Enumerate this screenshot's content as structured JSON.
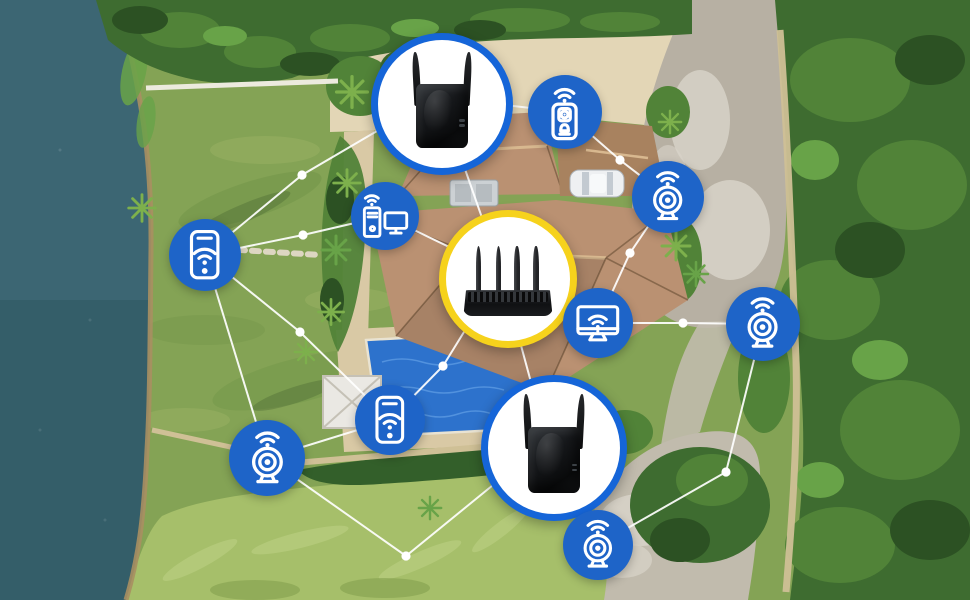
{
  "network": {
    "colors": {
      "circle_blue": "#1e64c8",
      "ring_blue": "#1565d8",
      "ring_yellow": "#f6d21c",
      "device_bg": "#ffffff",
      "line": "#ffffff",
      "icon_stroke": "#ffffff"
    },
    "nodes": [
      {
        "id": "extender-top",
        "kind": "device",
        "device": "wifi-extender",
        "ring": "blue",
        "x": 435,
        "y": 97,
        "r": 64
      },
      {
        "id": "doorbell",
        "kind": "icon",
        "icon": "video-doorbell",
        "x": 565,
        "y": 112,
        "r": 37
      },
      {
        "id": "phone-left",
        "kind": "icon",
        "icon": "smartphone",
        "x": 205,
        "y": 255,
        "r": 36
      },
      {
        "id": "desktop-pc",
        "kind": "icon",
        "icon": "desktop-pc",
        "x": 385,
        "y": 216,
        "r": 34
      },
      {
        "id": "router",
        "kind": "device",
        "device": "wifi-router",
        "ring": "yellow",
        "x": 501,
        "y": 272,
        "r": 62
      },
      {
        "id": "webcam-right",
        "kind": "icon",
        "icon": "webcam",
        "x": 668,
        "y": 197,
        "r": 36
      },
      {
        "id": "smart-monitor",
        "kind": "icon",
        "icon": "smart-monitor",
        "x": 598,
        "y": 323,
        "r": 35
      },
      {
        "id": "webcam-far-right",
        "kind": "icon",
        "icon": "webcam",
        "x": 763,
        "y": 324,
        "r": 37
      },
      {
        "id": "webcam-bottom-left",
        "kind": "icon",
        "icon": "webcam",
        "x": 267,
        "y": 458,
        "r": 38
      },
      {
        "id": "phone-bottom",
        "kind": "icon",
        "icon": "smartphone",
        "x": 390,
        "y": 420,
        "r": 35
      },
      {
        "id": "extender-bottom",
        "kind": "device",
        "device": "wifi-extender",
        "ring": "blue",
        "x": 547,
        "y": 441,
        "r": 66
      },
      {
        "id": "webcam-bottom",
        "kind": "icon",
        "icon": "webcam",
        "x": 598,
        "y": 545,
        "r": 35
      }
    ],
    "edges": [
      {
        "from": "phone-left",
        "to": "extender-top",
        "via": [
          [
            302,
            175
          ]
        ]
      },
      {
        "from": "phone-left",
        "to": "desktop-pc",
        "via": [
          [
            303,
            235
          ]
        ]
      },
      {
        "from": "phone-left",
        "to": "phone-bottom",
        "via": [
          [
            300,
            332
          ]
        ]
      },
      {
        "from": "phone-left",
        "to": "webcam-bottom-left"
      },
      {
        "from": "extender-top",
        "to": "doorbell"
      },
      {
        "from": "extender-top",
        "to": "router",
        "via": [
          [
            452,
            132
          ]
        ]
      },
      {
        "from": "desktop-pc",
        "to": "router"
      },
      {
        "from": "doorbell",
        "to": "webcam-right",
        "via": [
          [
            620,
            160
          ]
        ]
      },
      {
        "from": "webcam-right",
        "to": "smart-monitor",
        "via": [
          [
            630,
            253
          ]
        ]
      },
      {
        "from": "router",
        "to": "smart-monitor"
      },
      {
        "from": "smart-monitor",
        "to": "webcam-far-right",
        "via": [
          [
            683,
            323
          ]
        ]
      },
      {
        "from": "webcam-far-right",
        "to": "webcam-bottom",
        "via": [
          [
            726,
            472
          ]
        ]
      },
      {
        "from": "router",
        "to": "phone-bottom",
        "via": [
          [
            443,
            366
          ]
        ]
      },
      {
        "from": "router",
        "to": "extender-bottom"
      },
      {
        "from": "extender-bottom",
        "to": "webcam-bottom"
      },
      {
        "from": "webcam-bottom-left",
        "to": "extender-bottom",
        "via": [
          [
            406,
            556
          ]
        ]
      },
      {
        "from": "webcam-bottom-left",
        "to": "phone-bottom"
      }
    ]
  },
  "scene": {
    "palette": {
      "lawn": "#84a355",
      "lawn_shade": "#6f9347",
      "lawn_light": "#9ab164",
      "shadow": "#2f4b24",
      "water": "#3c6673",
      "water_deep": "#2b5560",
      "shore": "#a98f62",
      "tall_grass": "#a6bf6a",
      "tall_grass_light": "#bdd183",
      "tall_grass_dark": "#7f9c4b",
      "shrub": "#335f2a",
      "tree_dark": "#3e6c30",
      "tree_mid": "#518338",
      "tree_deep": "#2c5123",
      "tree_light": "#68a348",
      "palm": "#7db04c",
      "roof": "#ba9172",
      "roof_dark": "#a8825f",
      "roof_light": "#d8b88f",
      "roof_edge": "#7c5e43",
      "path": "#d9c9a5",
      "path_light": "#e3d6b6",
      "wall": "#cfc096",
      "fence": "#eceade",
      "driveway": "#b7b0a3",
      "driveway_light": "#d8d4c9",
      "gravel": "#c1bbad",
      "pool": "#2d72cc",
      "pool_light": "#62a0e6",
      "pool_edge": "#e9e3d2",
      "gazebo": "#eae8e3",
      "gazebo_line": "#c5c1b6",
      "car_body": "#eef0f2",
      "car_glass": "#c3cad1",
      "car_stroke": "#aab1b7",
      "unit": "#ccd1d4",
      "unit_inner": "#b6bcc0",
      "unit_stroke": "#9aa1a5",
      "stone": "#ddd6c2"
    }
  }
}
